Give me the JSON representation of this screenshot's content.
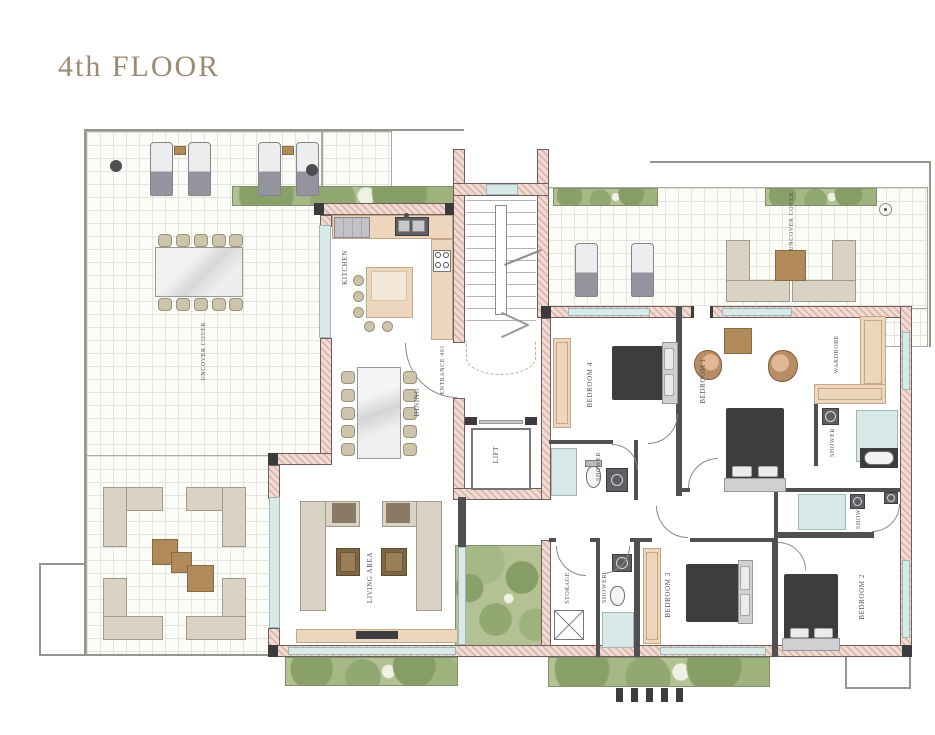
{
  "title": "4th FLOOR",
  "rooms": {
    "kitchen": "KITCHEN",
    "dining": "DINING",
    "living_area": "LIVING AREA",
    "entrance": "ENTRANCE 401",
    "lift": "LIFT",
    "storage": "STORAGE",
    "wardrobe": "WARDROBE",
    "bedroom_1": "BEDROOM 1",
    "bedroom_2": "BEDROOM 2",
    "bedroom_3": "BEDROOM 3",
    "bedroom_4": "BEDROOM 4",
    "shower": "SHOWER",
    "terrace": "UNCOVER COVER"
  },
  "colors": {
    "title_text": "#9c8b72",
    "wall_fill": "#f0dbd4",
    "wall_hatch": "#d8afa3",
    "interior_wall": "#505053",
    "glass": "#d8e9e8",
    "greenery": "#b3c194",
    "bed": "#3d3d40",
    "wood": "#b08a58",
    "sofa": "#d9d2c5",
    "counter": "#eed6bc"
  }
}
